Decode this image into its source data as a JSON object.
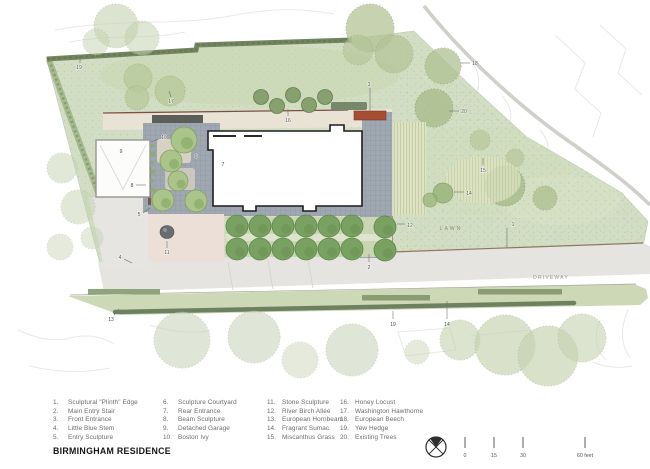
{
  "title": "BIRMINGHAM RESIDENCE",
  "legend": {
    "columns": [
      [
        {
          "n": "1.",
          "label": "Sculptural \"Plinth\" Edge"
        },
        {
          "n": "2.",
          "label": "Main Entry Stair"
        },
        {
          "n": "3.",
          "label": "Front Entrance"
        },
        {
          "n": "4.",
          "label": "Little Blue Stem"
        },
        {
          "n": "5.",
          "label": "Entry Sculpture"
        }
      ],
      [
        {
          "n": "6.",
          "label": "Sculpture Courtyard"
        },
        {
          "n": "7.",
          "label": "Rear Entrance"
        },
        {
          "n": "8.",
          "label": "Beam Sculpture"
        },
        {
          "n": "9.",
          "label": "Detached Garage"
        },
        {
          "n": "10.",
          "label": "Boston Ivy"
        }
      ],
      [
        {
          "n": "11.",
          "label": "Stone Sculpture"
        },
        {
          "n": "12.",
          "label": "River Birch Allée"
        },
        {
          "n": "13.",
          "label": "European Hornbeam"
        },
        {
          "n": "14.",
          "label": "Fragrant Sumac"
        },
        {
          "n": "15.",
          "label": "Miscanthus Grass"
        }
      ],
      [
        {
          "n": "16.",
          "label": "Honey Locust"
        },
        {
          "n": "17.",
          "label": "Washington Hawthorne"
        },
        {
          "n": "18.",
          "label": "European Beech"
        },
        {
          "n": "19.",
          "label": "Yew Hedge"
        },
        {
          "n": "20.",
          "label": "Existing Trees"
        }
      ]
    ]
  },
  "plan": {
    "area_labels": [
      {
        "text": "LAWN",
        "x": 451,
        "y": 230,
        "size": 5.2,
        "spacing": 2,
        "color": "#8a8e82"
      },
      {
        "text": "DRIVEWAY",
        "x": 551,
        "y": 279,
        "size": 5,
        "spacing": 1.2,
        "color": "#98968c"
      }
    ],
    "markers": [
      {
        "n": "19",
        "x": 79,
        "y": 69,
        "l": [
          80,
          63,
          80,
          56
        ]
      },
      {
        "n": "17",
        "x": 171,
        "y": 103,
        "l": [
          171,
          97,
          169,
          91
        ]
      },
      {
        "n": "18",
        "x": 475,
        "y": 65,
        "l": [
          470,
          63,
          461,
          63
        ]
      },
      {
        "n": "20",
        "x": 464,
        "y": 113,
        "l": [
          459,
          111,
          449,
          111
        ]
      },
      {
        "n": "16",
        "x": 288,
        "y": 122,
        "l": [
          288,
          116,
          288,
          109
        ]
      },
      {
        "n": "3",
        "x": 369,
        "y": 86,
        "l": [
          370,
          88,
          370,
          111
        ]
      },
      {
        "n": "10",
        "x": 164,
        "y": 139,
        "l": [
          158,
          139,
          151,
          142
        ]
      },
      {
        "n": "9",
        "x": 121,
        "y": 153
      },
      {
        "n": "6",
        "x": 196,
        "y": 158
      },
      {
        "n": "7",
        "x": 223,
        "y": 166
      },
      {
        "n": "8",
        "x": 132,
        "y": 187,
        "l": [
          136,
          185,
          146,
          185
        ]
      },
      {
        "n": "5",
        "x": 139,
        "y": 216,
        "l": [
          143,
          213,
          150,
          208
        ]
      },
      {
        "n": "4",
        "x": 120,
        "y": 259,
        "l": [
          124,
          259,
          132,
          263
        ]
      },
      {
        "n": "11",
        "x": 167,
        "y": 254,
        "l": [
          167,
          248,
          167,
          241
        ]
      },
      {
        "n": "2",
        "x": 369,
        "y": 269,
        "l": [
          369,
          262,
          369,
          254
        ]
      },
      {
        "n": "12",
        "x": 410,
        "y": 227,
        "l": [
          405,
          224,
          397,
          224
        ]
      },
      {
        "n": "1",
        "x": 513,
        "y": 226,
        "l": [
          507,
          228,
          507,
          248
        ]
      },
      {
        "n": "15",
        "x": 483,
        "y": 172,
        "l": [
          483,
          165,
          483,
          158
        ]
      },
      {
        "n": "14",
        "x": 469,
        "y": 195,
        "l": [
          464,
          192,
          454,
          192
        ]
      },
      {
        "n": "13",
        "x": 111,
        "y": 321,
        "l": [
          114,
          315,
          119,
          309
        ]
      },
      {
        "n": "19",
        "x": 393,
        "y": 326,
        "l": [
          393,
          319,
          393,
          311
        ]
      },
      {
        "n": "14",
        "x": 447,
        "y": 326,
        "l": [
          447,
          319,
          447,
          301
        ]
      }
    ]
  },
  "scale_bar": {
    "ticks": [
      {
        "x": 465,
        "label": "0"
      },
      {
        "x": 494,
        "label": "15"
      },
      {
        "x": 523,
        "label": "30"
      },
      {
        "x": 585,
        "label": "60 feet"
      }
    ]
  },
  "north_arrow": "compass-circle",
  "colors": {
    "lawn": "#d2dec4",
    "hedge": "#72855f",
    "pavers": "#9fa8b1",
    "walk_beige": "#e9e3d6",
    "terrace_pink": "#ebdfd8",
    "bench_red": "#a54e33",
    "driveway": "#e5e4e0",
    "allee_tree": "#79a161",
    "house_outline": "#1d1d1d"
  }
}
